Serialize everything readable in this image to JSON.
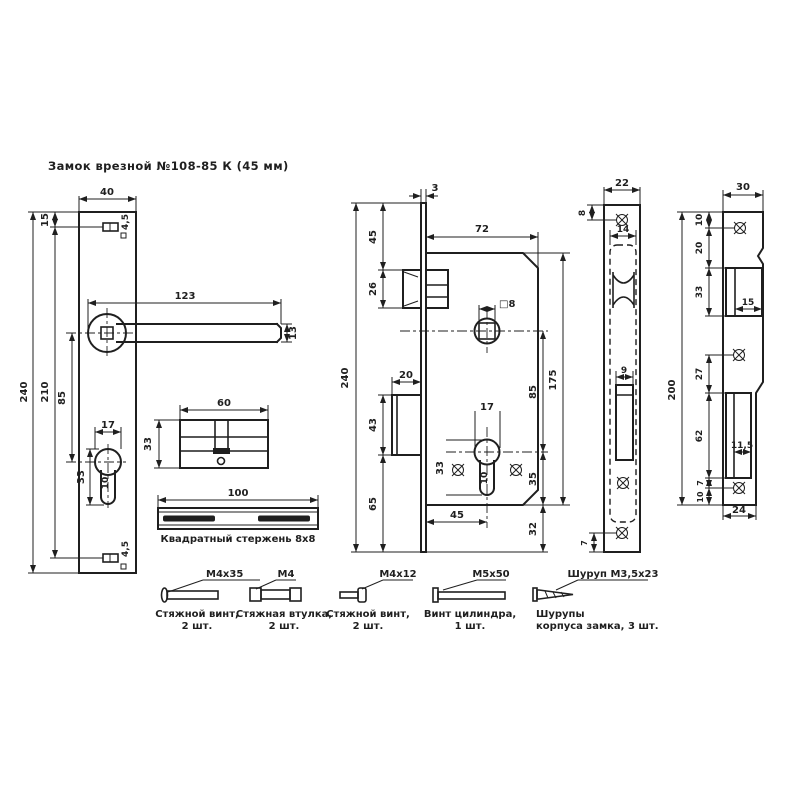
{
  "title": "Замок врезной №108-85 К (45 мм)",
  "colors": {
    "ink": "#1f1f1f",
    "paper": "#ffffff"
  },
  "views": {
    "escutcheon": {
      "dims": {
        "width": "40",
        "top_hole": "15",
        "height": "240",
        "hole_span": "210",
        "handle_to_key": "85",
        "lever_length": "123",
        "lever_width": "13",
        "key_width": "17",
        "key_height": "33",
        "key_stem": "10",
        "top_hole_dia": "4,5",
        "bottom_hole_dia": "4,5"
      }
    },
    "cylinder": {
      "dims": {
        "length": "60",
        "height": "33"
      }
    },
    "rod": {
      "length": "100",
      "caption": "Квадратный стержень 8х8"
    },
    "body": {
      "dims": {
        "face_thickness": "3",
        "height": "240",
        "top_to_latch": "45",
        "latch_height": "26",
        "bolt_throw": "20",
        "bolt_height": "43",
        "bottom_section": "65",
        "depth": "72",
        "spindle_square": "□8",
        "cyl_width": "17",
        "cyl_height": "33",
        "cyl_stem": "10",
        "backset": "45",
        "spindle_to_cyl": "85",
        "cyl_to_bottom": "35",
        "body_height": "175",
        "bottom_offset": "32"
      }
    },
    "faceplate": {
      "dims": {
        "width": "22",
        "top_to_screw": "8",
        "body_width": "14",
        "bolt_slot": "9",
        "bottom_to_screw": "7"
      }
    },
    "strike": {
      "dims": {
        "top_width": "30",
        "height": "200",
        "top_to_screw": "10",
        "screw_to_latch": "20",
        "latch_height": "33",
        "latch_width": "15",
        "screw_gap": "27",
        "bolt_height": "62",
        "bolt_width": "11,5",
        "bolt_to_screw": "7",
        "screw_to_bottom": "10",
        "bottom_width": "24"
      }
    }
  },
  "fasteners": [
    {
      "size": "М4х35",
      "line1": "Стяжной винт,",
      "line2": "2 шт."
    },
    {
      "size": "М4",
      "line1": "Стяжная втулка,",
      "line2": "2 шт."
    },
    {
      "size": "М4х12",
      "line1": "Стяжной винт,",
      "line2": "2 шт."
    },
    {
      "size": "М5х50",
      "line1": "Винт цилиндра,",
      "line2": "1 шт."
    },
    {
      "size": "Шуруп М3,5х23",
      "line1": "Шурупы",
      "line2": "корпуса замка, 3 шт."
    }
  ]
}
